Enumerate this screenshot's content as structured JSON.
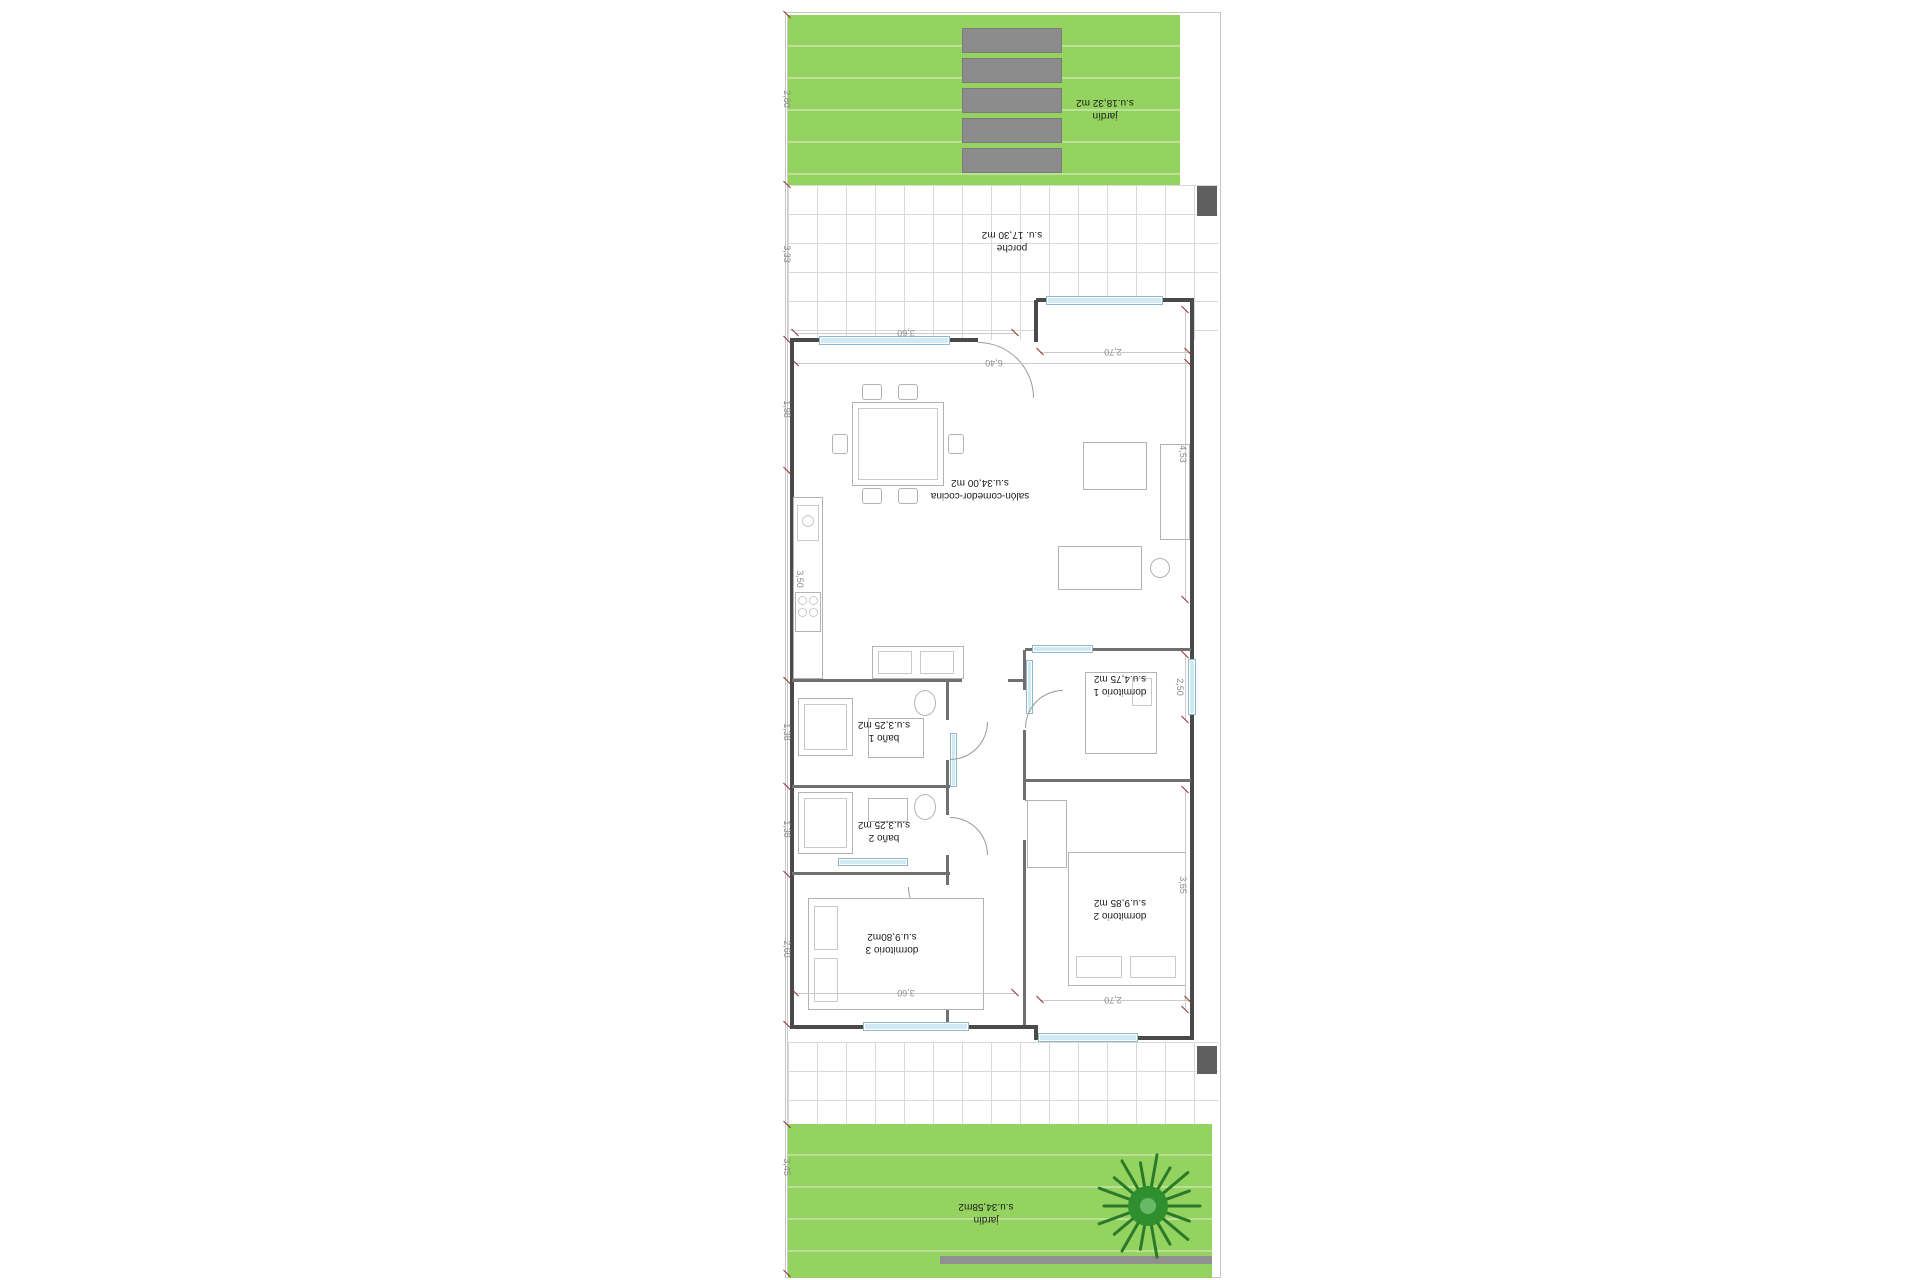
{
  "rooms": {
    "jardin_top": {
      "label": "jardín",
      "area": "s.u.18,32 m2"
    },
    "porche": {
      "label": "porche",
      "area": "s.u. 17,30 m2"
    },
    "salon": {
      "label": "salón-comedor-cocina",
      "area": "s.u.34,00 m2"
    },
    "dormitorio1": {
      "label": "dormitorio 1",
      "area": "s.u.4,75 m2"
    },
    "bano1": {
      "label": "baño 1",
      "area": "s.u.3,25 m2"
    },
    "bano2": {
      "label": "baño 2",
      "area": "s.u.3,25 m2"
    },
    "dormitorio2": {
      "label": "dormitorio 2",
      "area": "s.u.9,85 m2"
    },
    "dormitorio3": {
      "label": "dormitorio 3",
      "area": "s.u.9,80m2"
    },
    "jardin_bottom": {
      "label": "jardín",
      "area": "s.u.34,58m2"
    }
  },
  "dimensions": {
    "left": [
      "2,80",
      "3,33",
      "1,98",
      "3,50",
      "1,38",
      "1,38",
      "2,60",
      "3,45"
    ],
    "top": [
      "3,60",
      "6,40",
      "2,70"
    ],
    "right": [
      "4,53",
      "2,50",
      "3,65"
    ],
    "bottom": [
      "3,60",
      "2,70"
    ]
  },
  "colors": {
    "garden_green": "#94d35f",
    "paver_gray": "#8c8c8c",
    "window_blue": "#cfe9f5",
    "wall_dark": "#4a4a4a",
    "tick_red": "#8b3434",
    "plant_green": "#2a7a2a"
  }
}
